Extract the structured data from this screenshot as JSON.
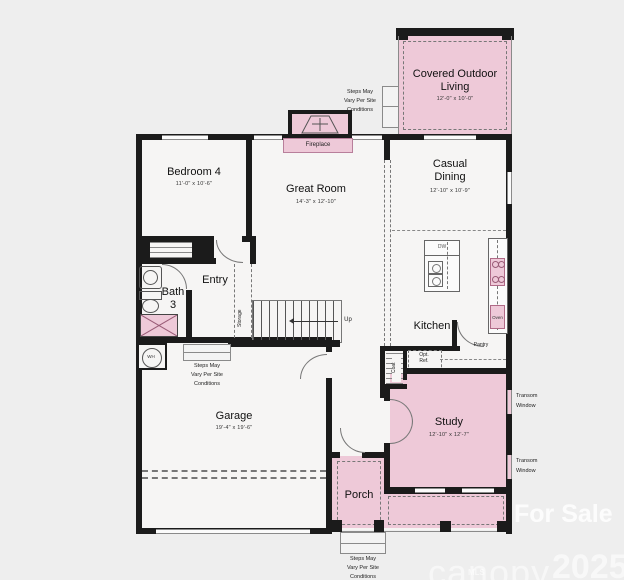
{
  "rooms": {
    "covered_outdoor_living": {
      "name": "Covered Outdoor Living",
      "dims": "12'-0\" x 10'-0\""
    },
    "bedroom4": {
      "name": "Bedroom 4",
      "dims": "11'-0\" x 10'-6\""
    },
    "great_room": {
      "name": "Great Room",
      "dims": "14'-3\" x 12'-10\""
    },
    "casual_dining": {
      "name": "Casual\nDining",
      "dims": "12'-10\" x 10'-9\""
    },
    "kitchen": {
      "name": "Kitchen"
    },
    "entry": {
      "name": "Entry"
    },
    "bath3": {
      "name": "Bath\n3"
    },
    "garage": {
      "name": "Garage",
      "dims": "19'-4\" x 19'-6\""
    },
    "study": {
      "name": "Study",
      "dims": "12'-10\" x 12'-7\""
    },
    "porch": {
      "name": "Porch"
    }
  },
  "labels": {
    "fireplace": "Fireplace",
    "up": "Up",
    "storage": "Storage",
    "coat": "Coat",
    "pantry": "Pantry",
    "opt_ref": "Opt.\nRef.",
    "dw": "DW",
    "oven": "Oven",
    "wh": "WH",
    "transom": "Transom\nWindow",
    "steps_note": "Steps May\nVary Per Site\nConditions"
  },
  "watermark": {
    "for_sale": "For Sale",
    "brand": "canopy",
    "mls": "MLS",
    "year": "2025"
  },
  "colors": {
    "highlight_pink": "#eec9d8",
    "wall": "#1b1b1b",
    "background": "#eeeeee"
  }
}
